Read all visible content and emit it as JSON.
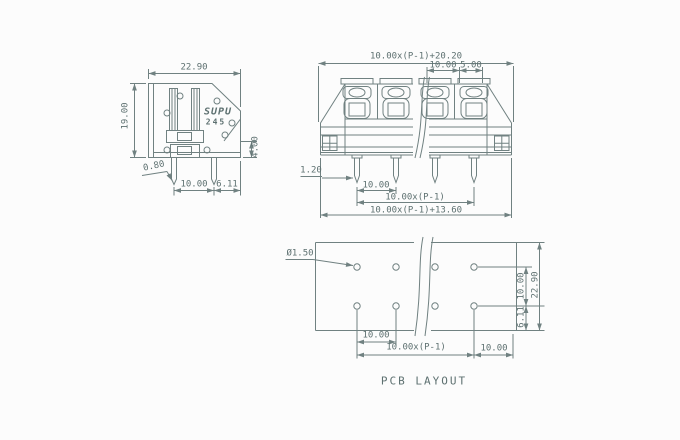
{
  "drawing": {
    "caption": "PCB LAYOUT",
    "logo": {
      "brand": "SUPU",
      "model": "245"
    },
    "side_view": {
      "width": "22.90",
      "height": "19.00",
      "pin_step": "4.00",
      "pin_width": "0.80",
      "pin_pitch": "10.00",
      "pin_edge": "6.11"
    },
    "front_view": {
      "overall_width": "10.00x(P-1)+20.20",
      "pitch": "10.00",
      "half_pitch": "5.00",
      "pin_width": "1.20",
      "pin_pitch": "10.00",
      "pin_span": "10.00x(P-1)",
      "mounting_width": "10.00x(P-1)+13.60"
    },
    "pcb_layout": {
      "hole_dia": "Ø1.50",
      "row_spacing": "10.00",
      "edge_clearance": "6.11",
      "height": "22.90",
      "pitch": "10.00",
      "span": "10.00x(P-1)",
      "end_offset": "10.00"
    }
  }
}
